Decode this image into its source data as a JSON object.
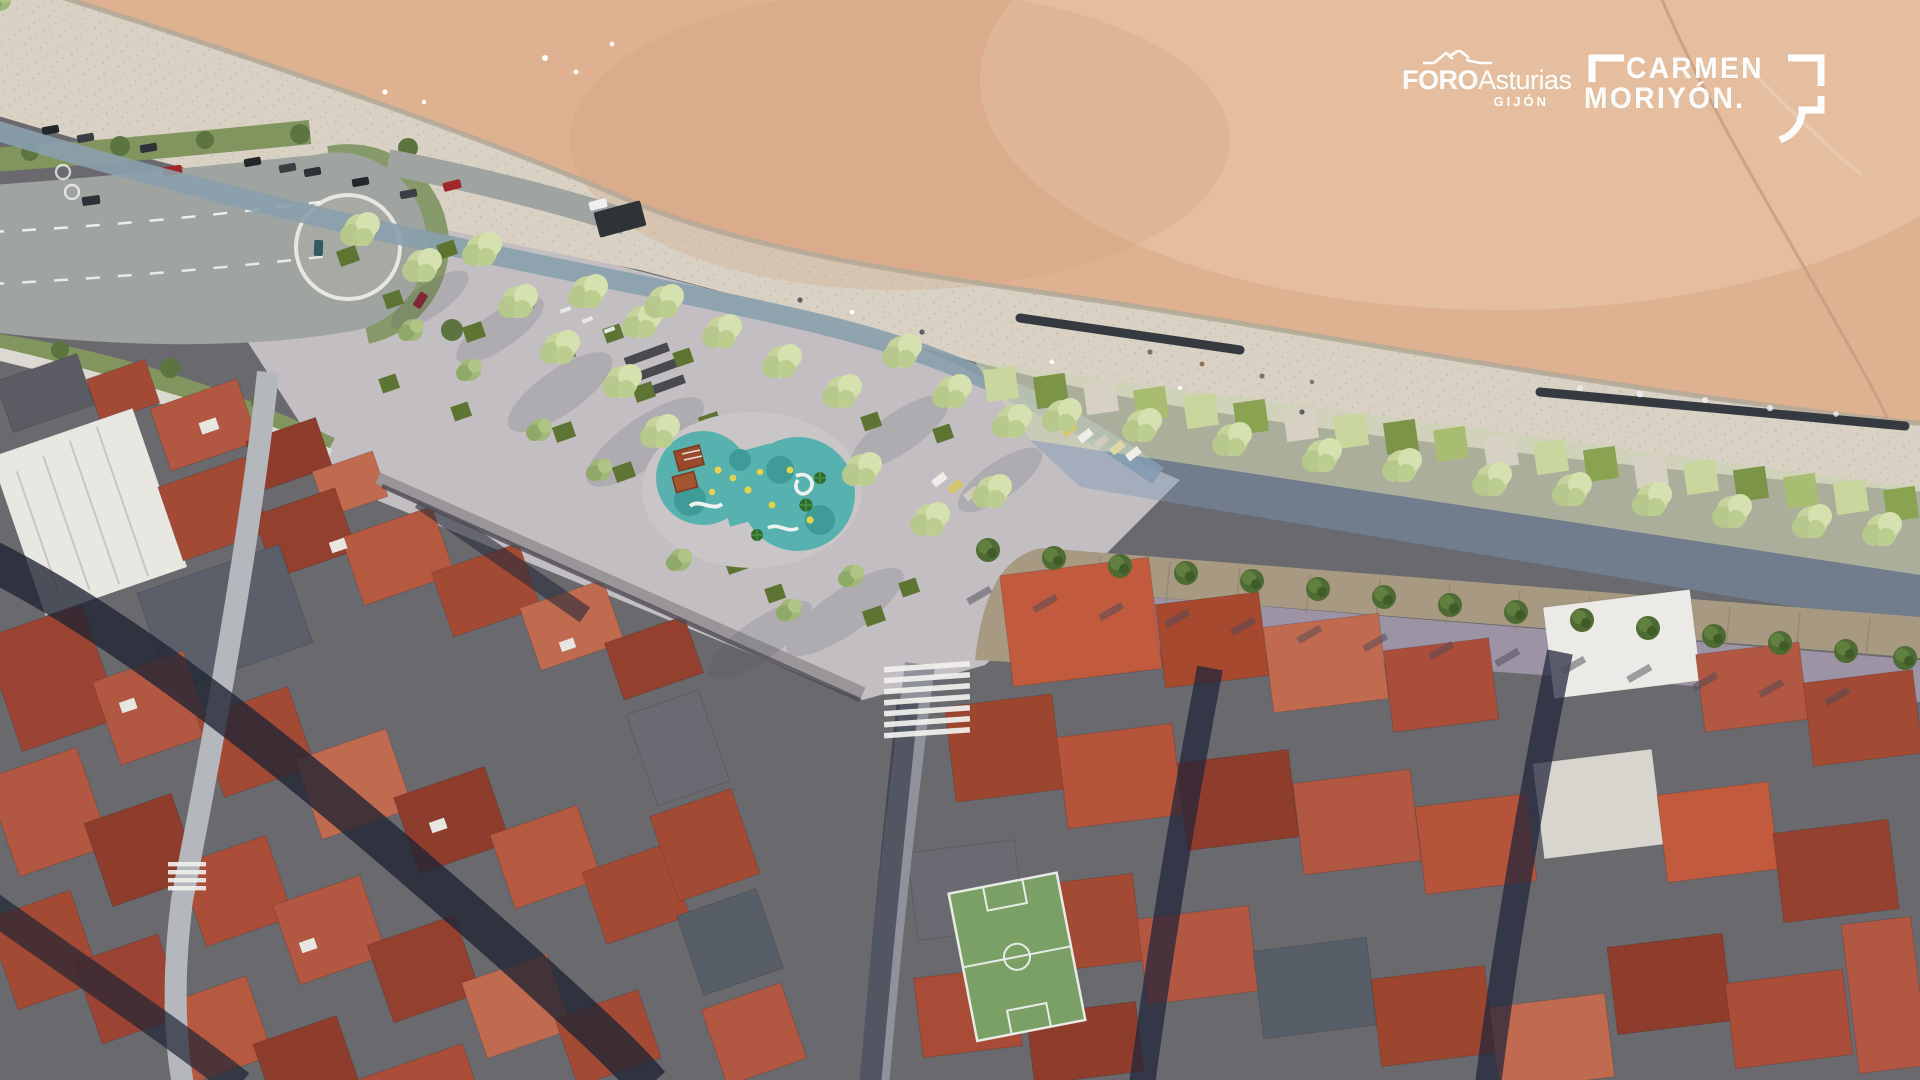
{
  "logos": {
    "foro": {
      "brand": "FORO",
      "brand_suffix": "Asturias",
      "city": "GIJÓN",
      "icon": "roofline-zigzag-icon",
      "color": "#ffffff"
    },
    "carmen": {
      "line1": "CARMEN",
      "line2": "MORIYÓN.",
      "icon": "speech-bubble-brackets-icon",
      "color": "#ffffff"
    }
  },
  "palette": {
    "beach_sand": "#deb191",
    "beach_light": "#eccfb0",
    "promenade": "#d8d1c4",
    "bike_path": "#8aa0ad",
    "asphalt": "#a0a4a1",
    "grass_verge": "#82955f",
    "park_canopy": "#c6d49c",
    "hedge_dark": "#5e7433",
    "playground_teal": "#57b1ae",
    "plaza": "#c2bec1",
    "boulevard_wall": "#a89a82",
    "street_new": "#9c93a4",
    "roof_red": "#a84b37",
    "roof_dark": "#55565e",
    "roof_white": "#e9e7e2",
    "shadow_street": "#1f2433",
    "seawall_dark": "#353a41"
  }
}
